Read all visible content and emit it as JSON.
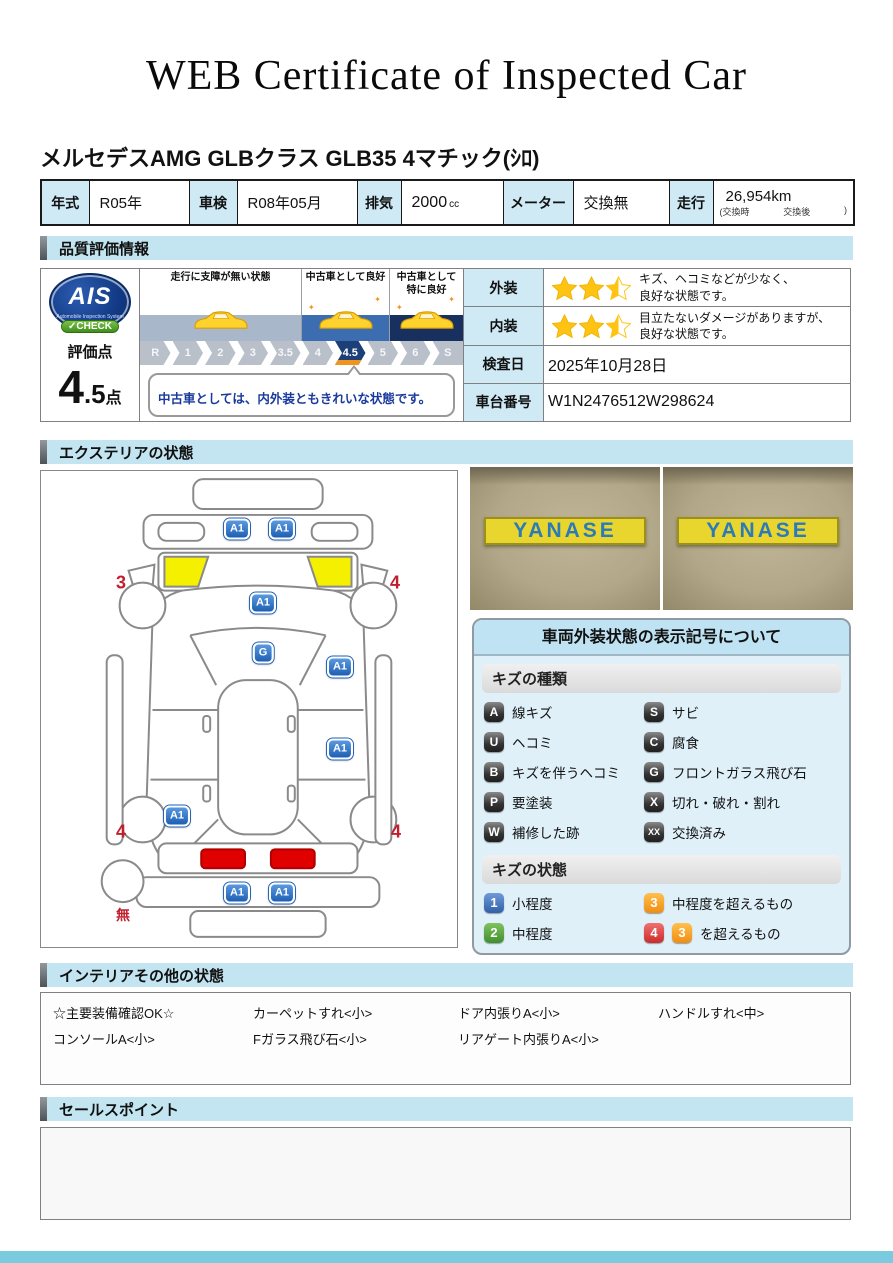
{
  "header": {
    "title": "WEB Certificate of Inspected Car",
    "vehicle_name": "メルセデスAMG GLBクラス GLB35 4マチック(ｼﾛ)"
  },
  "spec": {
    "year": {
      "label": "年式",
      "value": "R05年"
    },
    "shaken": {
      "label": "車検",
      "value": "R08年05月"
    },
    "displacement": {
      "label": "排気",
      "value": "2000",
      "unit": "cc"
    },
    "meter": {
      "label": "メーター",
      "value": "交換無"
    },
    "mileage": {
      "label": "走行",
      "value": "26,954km",
      "sub_open": "(交換時",
      "sub_mid": "交換後",
      "sub_close": ")"
    }
  },
  "sections": {
    "quality": "品質評価情報",
    "exterior": "エクステリアの状態",
    "interior": "インテリアその他の状態",
    "sales": "セールスポイント"
  },
  "quality": {
    "ais": {
      "logo_text": "AIS",
      "logo_sub": "Automobile Inspection System",
      "check_label": "✓CHECK"
    },
    "score_label": "評価点",
    "score_int": "4",
    "score_dec": ".5",
    "score_unit": "点",
    "zones": [
      "走行に支障が無い状態",
      "中古車として良好",
      "中古車として\n特に良好"
    ],
    "steps": [
      "R",
      "1",
      "2",
      "3",
      "3.5",
      "4",
      "4.5",
      "5",
      "6",
      "S"
    ],
    "selected_step": "4.5",
    "comment": "中古車としては、内外装ともきれいな状態です。",
    "rows": [
      {
        "label": "外装",
        "stars": "2.5",
        "line1": "キズ、ヘコミなどが少なく、",
        "line2": "良好な状態です。"
      },
      {
        "label": "内装",
        "stars": "2.5",
        "line1": "目立たないダメージがありますが、",
        "line2": "良好な状態です。"
      },
      {
        "label": "検査日",
        "value": "2025年10月28日"
      },
      {
        "label": "車台番号",
        "value": "W1N2476512W298624"
      }
    ]
  },
  "exterior": {
    "photos": [
      {
        "sign": "YANASE"
      },
      {
        "sign": "YANASE"
      }
    ],
    "markers": [
      {
        "label": "A1",
        "area": "front-bumper-left"
      },
      {
        "label": "A1",
        "area": "front-bumper-right"
      },
      {
        "label": "3",
        "area": "front-left-wheel"
      },
      {
        "label": "4",
        "area": "front-right-wheel"
      },
      {
        "label": "A1",
        "area": "hood"
      },
      {
        "label": "G",
        "area": "windshield"
      },
      {
        "label": "A1",
        "area": "front-right-door"
      },
      {
        "label": "A1",
        "area": "rear-right-door"
      },
      {
        "label": "A1",
        "area": "rear-left-fender"
      },
      {
        "label": "4",
        "area": "rear-left-wheel"
      },
      {
        "label": "4",
        "area": "rear-right-wheel"
      },
      {
        "label": "A1",
        "area": "rear-bumper-left"
      },
      {
        "label": "A1",
        "area": "rear-bumper-right"
      },
      {
        "label": "無",
        "area": "spare-tire"
      }
    ],
    "legend": {
      "title": "車両外装状態の表示記号について",
      "kind_header": "キズの種類",
      "kinds": [
        {
          "code": "A",
          "label": "線キズ"
        },
        {
          "code": "S",
          "label": "サビ"
        },
        {
          "code": "U",
          "label": "ヘコミ"
        },
        {
          "code": "C",
          "label": "腐食"
        },
        {
          "code": "B",
          "label": "キズを伴うヘコミ"
        },
        {
          "code": "G",
          "label": "フロントガラス飛び石"
        },
        {
          "code": "P",
          "label": "要塗装"
        },
        {
          "code": "X",
          "label": "切れ・破れ・割れ"
        },
        {
          "code": "W",
          "label": "補修した跡"
        },
        {
          "code": "XX",
          "label": "交換済み"
        }
      ],
      "state_header": "キズの状態",
      "states": [
        {
          "code": "1",
          "label": "小程度",
          "color": "#2f5fa8"
        },
        {
          "code": "3",
          "label": "中程度を超えるもの",
          "color": "#ef8d12"
        },
        {
          "code": "2",
          "label": "中程度",
          "color": "#3f8f2e"
        },
        {
          "code": "4",
          "extra_code": "3",
          "label": "を超えるもの",
          "color": "#cc2b2b"
        }
      ]
    }
  },
  "interior": {
    "items": [
      "☆主要装備確認OK☆",
      "カーペットすれ<小>",
      "ドア内張りA<小>",
      "ハンドルすれ<中>",
      "コンソールA<小>",
      "Fガラス飛び石<小>",
      "リアゲート内張りA<小>",
      ""
    ]
  },
  "colors": {
    "section_header_bg": "#c3e5f1",
    "selected_step_blue": "#1d3f77",
    "highlight_orange": "#f0941e",
    "marker_badge_blue": "#1e5fb4",
    "marker_number_red": "#c11f2e",
    "star_yellow": "#ffc413",
    "sign_yellow": "#e8d62e",
    "sign_text_blue": "#2d7ab8",
    "tail_light_red": "#e00000",
    "headlight_highlight_yellow": "#f5ef00",
    "bottom_bar_teal": "#7bcbde"
  }
}
